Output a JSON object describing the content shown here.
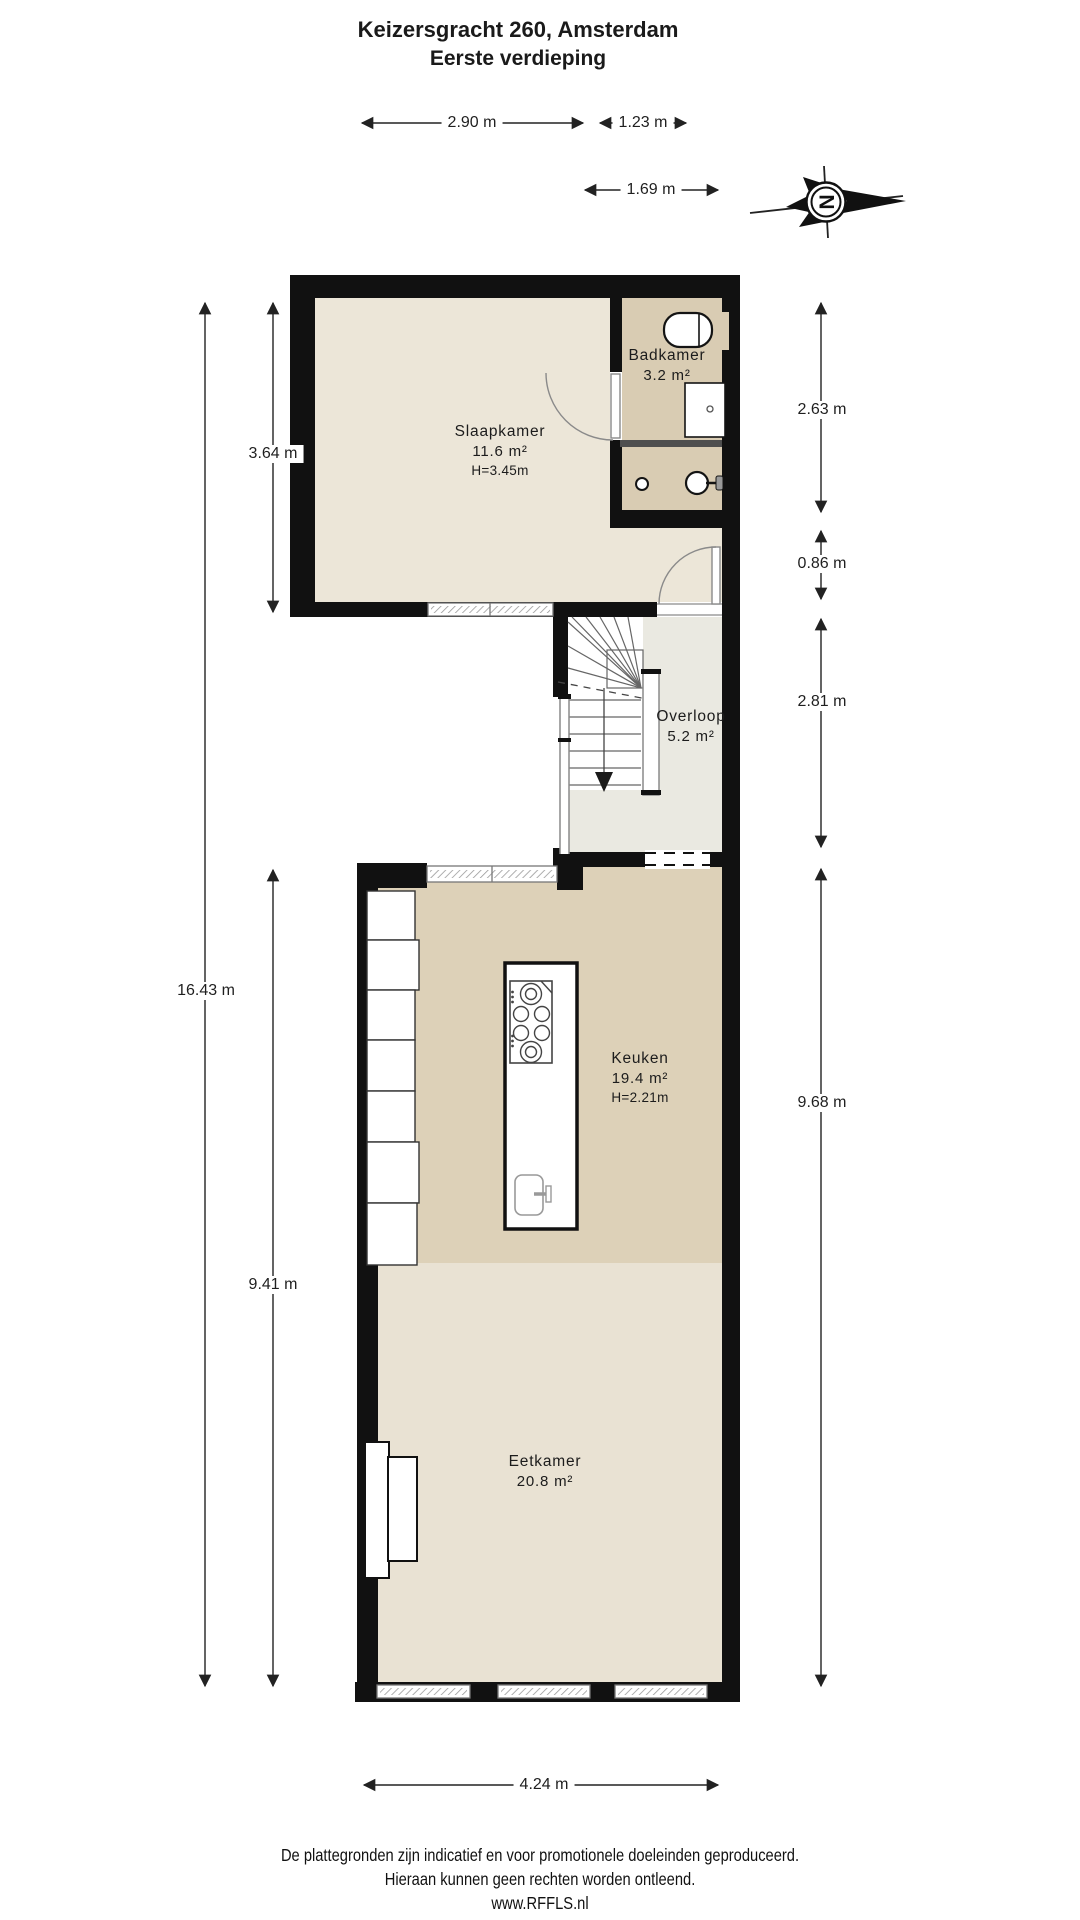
{
  "title": {
    "line1": "Keizersgracht 260, Amsterdam",
    "line2": "Eerste verdieping"
  },
  "compass": {
    "letter": "N"
  },
  "rooms": {
    "slaapkamer": {
      "name": "Slaapkamer",
      "area": "11.6 m²",
      "height": "H=3.45m"
    },
    "badkamer": {
      "name": "Badkamer",
      "area": "3.2 m²"
    },
    "overloop": {
      "name": "Overloop",
      "area": "5.2 m²"
    },
    "keuken": {
      "name": "Keuken",
      "area": "19.4 m²",
      "height": "H=2.21m"
    },
    "eetkamer": {
      "name": "Eetkamer",
      "area": "20.8 m²"
    }
  },
  "dimensions": {
    "top_left": "2.90 m",
    "top_right": "1.23 m",
    "top_inner": "1.69 m",
    "left_slaapkamer": "3.64 m",
    "left_total": "16.43 m",
    "left_lower": "9.41 m",
    "right_badkamer": "2.63 m",
    "right_strip": "0.86 m",
    "right_overloop": "2.81 m",
    "right_lower": "9.68 m",
    "bottom_width": "4.24 m"
  },
  "footer": {
    "line1": "De plattegronden zijn indicatief en voor promotionele doeleinden geproduceerd.",
    "line2": "Hieraan kunnen geen rechten worden ontleend.",
    "line3": "www.RFFLS.nl"
  },
  "colors": {
    "wall": "#111111",
    "slaapkamer": "#ECE6D8",
    "badkamer": "#D9CCB3",
    "overloop": "#EAE9E1",
    "keuken": "#DDD1B8",
    "eetkamer": "#E9E2D3",
    "divider": "#4F4F4F"
  }
}
